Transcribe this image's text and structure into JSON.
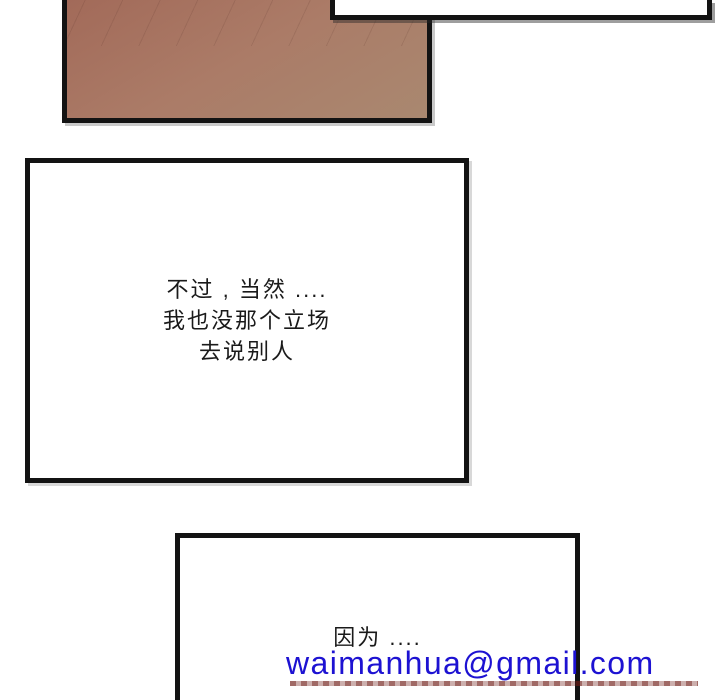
{
  "colors": {
    "background": "#ffffff",
    "border": "#131313",
    "text": "#1a1a1a",
    "art_top": "#a26a59",
    "art_mid": "#ab7b67",
    "art_bottom": "#a98870",
    "email_blue": "#1d12d2",
    "underline_red": "#6e1a14"
  },
  "panels": {
    "middle": {
      "lines": {
        "0": "不过 , 当然 ....",
        "1": "我也没那个立场",
        "2": "去说别人"
      }
    },
    "bottom": {
      "text": "因为 ...."
    }
  },
  "watermark": {
    "email": "waimanhua@gmail.com"
  }
}
